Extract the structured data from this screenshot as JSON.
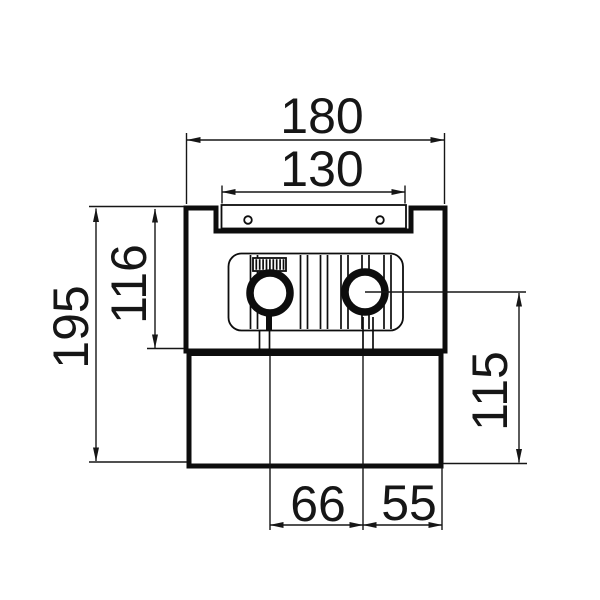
{
  "drawing": {
    "type": "technical-dimension-drawing",
    "colors": {
      "ink": "#0d0d0d",
      "background": "#ffffff"
    },
    "dimensions": {
      "overall_width": "180",
      "top_grille_width": "130",
      "casing_height": "116",
      "overall_height": "195",
      "pipe_axis_to_bottom_height": "115",
      "pipe_spacing": "66",
      "pipe_to_edge": "55"
    }
  }
}
